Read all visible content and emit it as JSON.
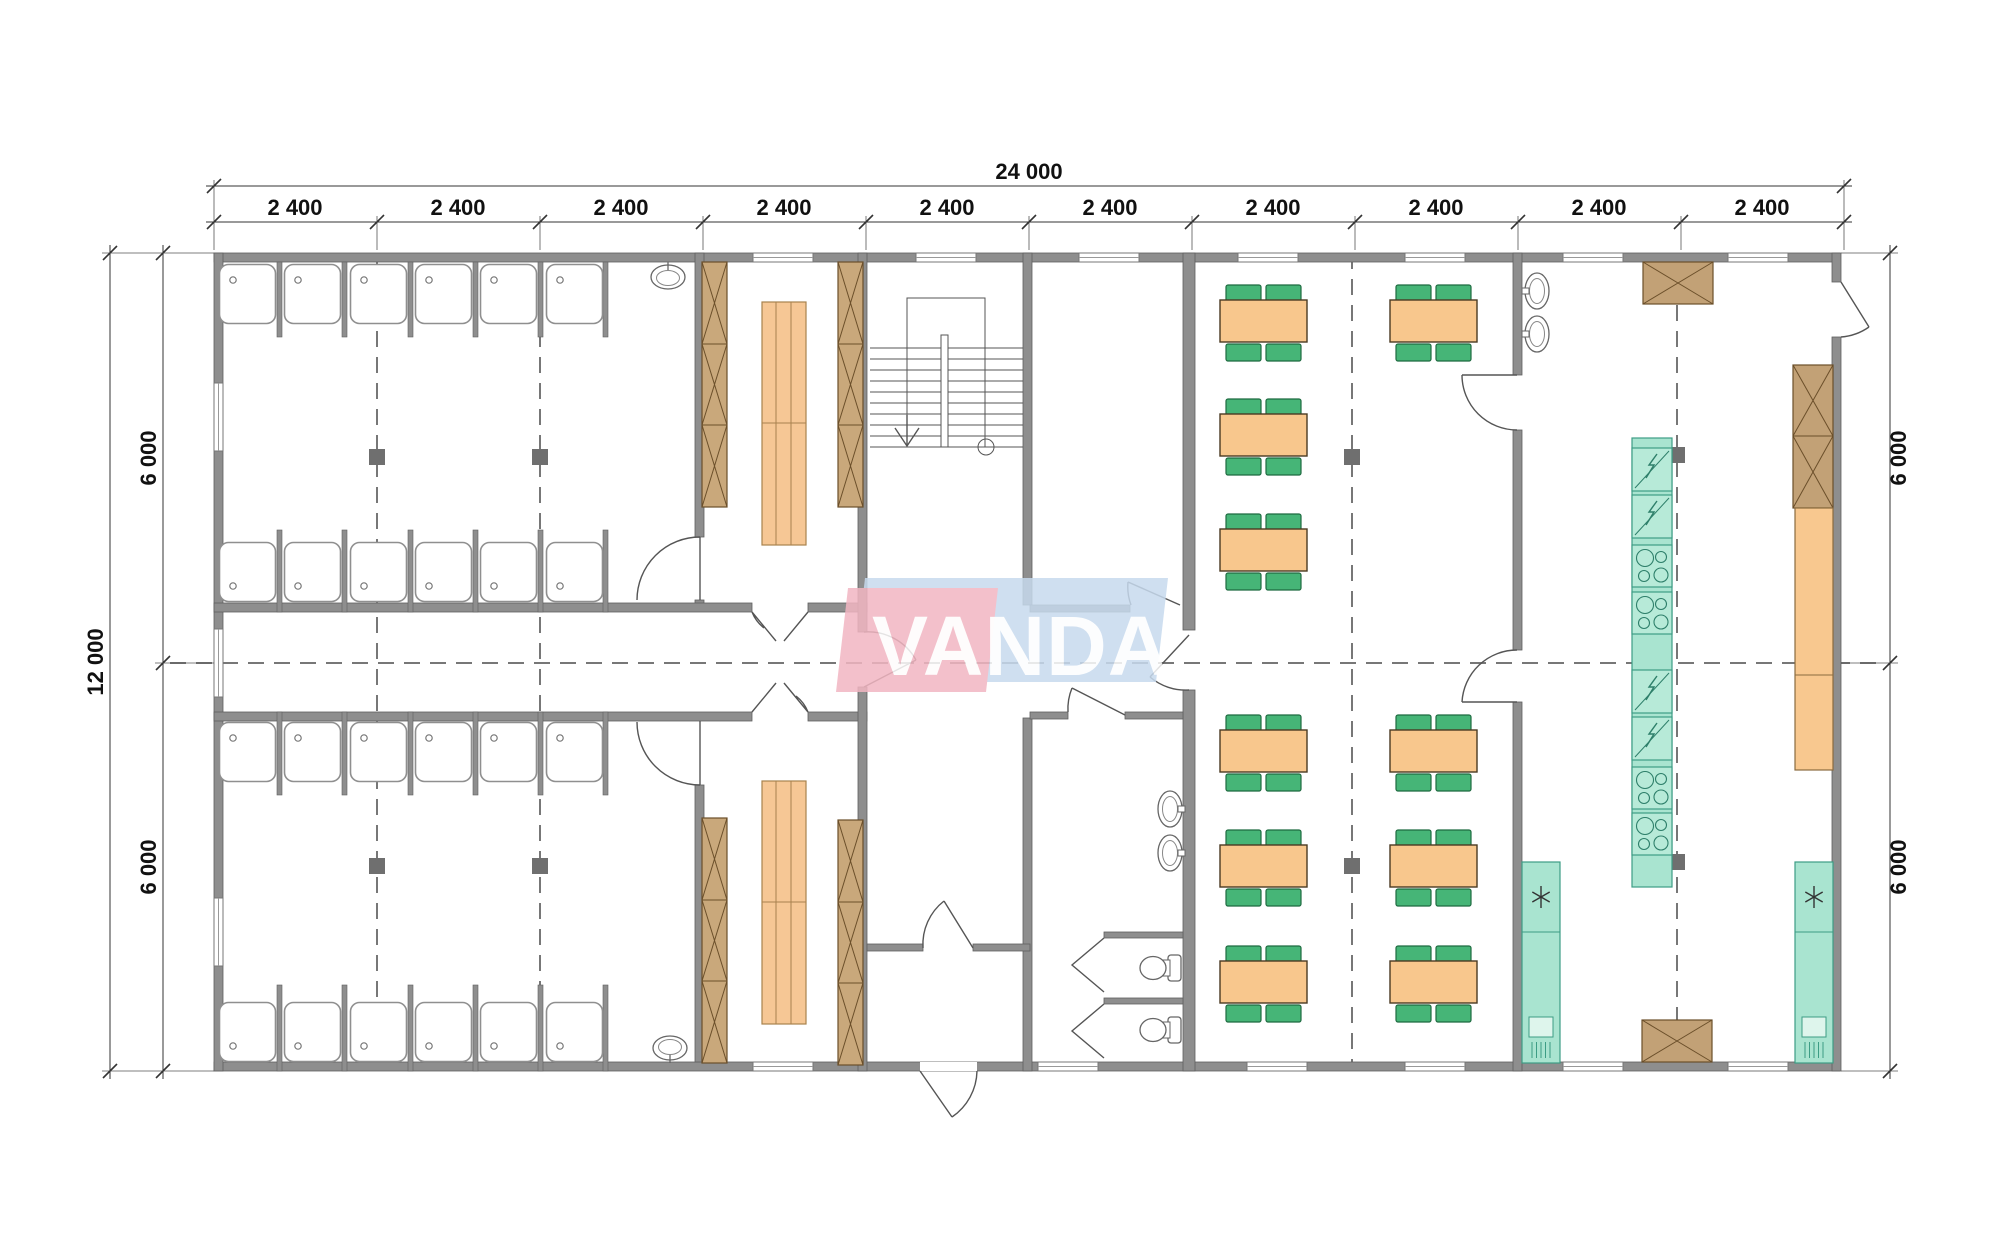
{
  "dimensions": {
    "top_total": "24 000",
    "top_segments": [
      "2 400",
      "2 400",
      "2 400",
      "2 400",
      "2 400",
      "2 400",
      "2 400",
      "2 400",
      "2 400",
      "2 400"
    ],
    "left_total": "12 000",
    "left_segments": [
      "6 000",
      "6 000"
    ],
    "right_segments": [
      "6 000",
      "6 000"
    ]
  },
  "logo": {
    "text": "VANDA",
    "pink": "#f2b6c2",
    "blue": "#c7daee"
  },
  "palette": {
    "wall": "#8e8e8e",
    "wall_edge": "#5f5f5f",
    "locker_wood": "#c9a87b",
    "bench_wood": "#f6c795",
    "table": "#f8c78d",
    "chair": "#46b577",
    "equipment_teal": "#a9e4d0",
    "counter": "#f8c88f",
    "dim_text": "#111111",
    "grid_dash": "#777777"
  },
  "inventory": {
    "shower_cabins": 24,
    "shower_room_sinks": 2,
    "kitchen_basins": 2,
    "lavatory_basins": 2,
    "toilets": 2,
    "dining_tables": 10,
    "chairs_per_table": 4,
    "locker_columns": 4,
    "wardrobe_benches": 2,
    "stoves": 4,
    "electric_units": 4,
    "refrigerators": 2,
    "storage_cabinets": 4
  }
}
